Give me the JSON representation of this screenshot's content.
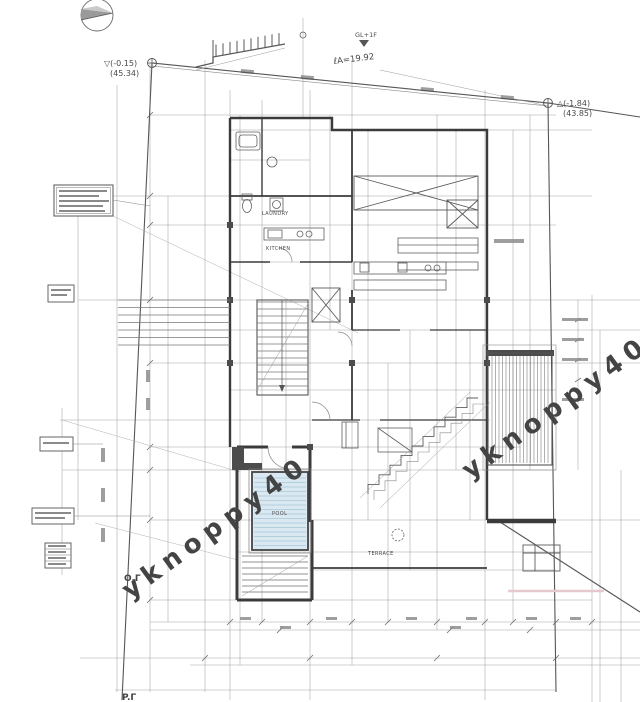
{
  "page": {
    "background": "#ffffff"
  },
  "drawing": {
    "type": "architectural-site-plan",
    "benchmark_left": {
      "line1": "▽(-0.15)",
      "line2": "(45.34)"
    },
    "benchmark_right": {
      "line1": "△(-1.84)",
      "line2": "(43.85)"
    },
    "boundary_length_label": "ℓA=19.92",
    "level_flag_label": "GL+1F",
    "rooms": {
      "laundry": "LAUNDRY",
      "kitchen": "KITCHEN",
      "pool": "POOL",
      "terrace": "TERRACE"
    },
    "markers": {
      "pink": {
        "text": "O.Γ",
        "color": "#c4687a"
      },
      "green": {
        "text": "P.Γ",
        "color": "#6fa076"
      }
    },
    "watermark": {
      "text": "yknoppy40",
      "color": "rgba(150,140,158,0.32)"
    }
  }
}
